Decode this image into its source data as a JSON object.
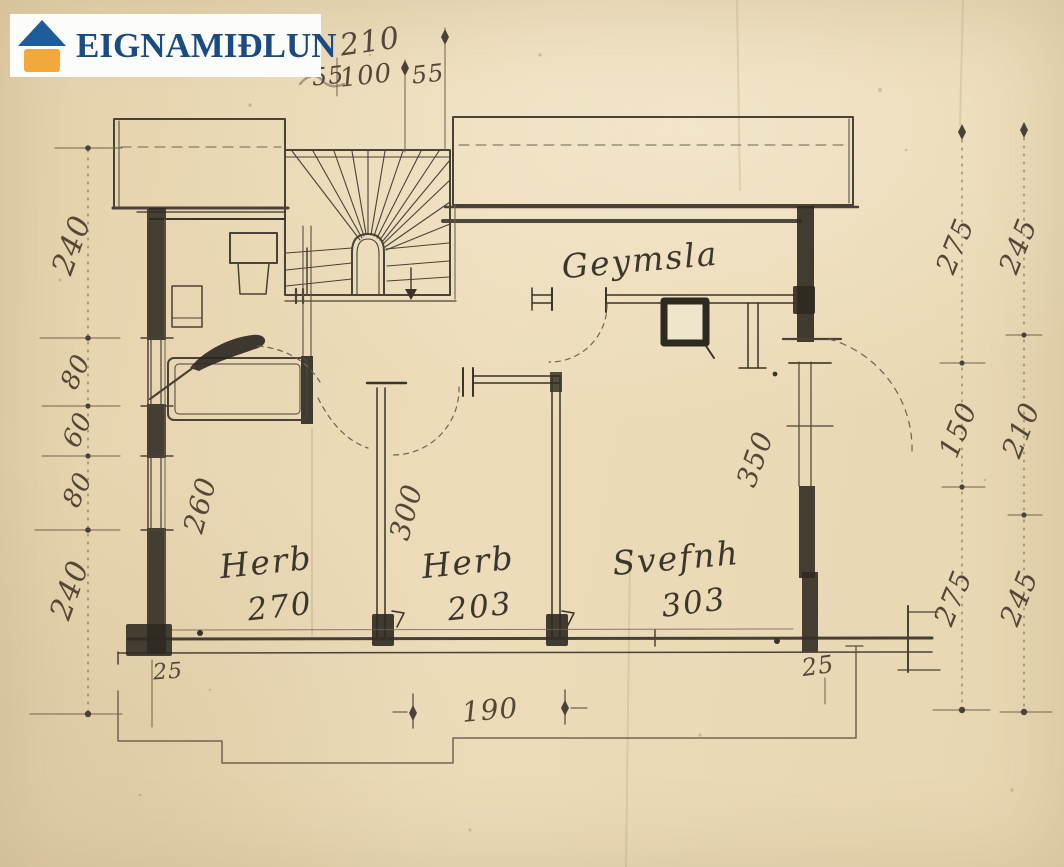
{
  "logo": {
    "name": "EIGNAMIÐLUN"
  },
  "plan": {
    "rooms": {
      "geymsla": "Geymsla",
      "herb1": "Herb",
      "herb1_area": "270",
      "herb2": "Herb",
      "herb2_area": "203",
      "svefnh": "Svefnh",
      "svefnh_area": "303"
    },
    "dims": {
      "top_total": "210",
      "top_parts": [
        "55",
        "100",
        "55"
      ],
      "left": [
        "240",
        "80",
        "60",
        "80",
        "240"
      ],
      "right_inner": [
        "275",
        "150",
        "275"
      ],
      "right_outer": [
        "245",
        "210",
        "245"
      ],
      "room_widths": {
        "herb1": "260",
        "herb2": "300",
        "svefnh": "350"
      },
      "bottom": {
        "left_offset": "25",
        "porch_width": "190",
        "right_offset": "25"
      }
    }
  },
  "colors": {
    "paper": "#e8d8b5",
    "ink": "#4a4238",
    "ink_dark": "#2e2921",
    "dim_line": "#6f6250",
    "logo_text_blue": "#1b4b83",
    "logo_roof_blue": "#1e5c99",
    "logo_orange": "#f2a83b",
    "logo_bg": "#fcfcfb"
  }
}
